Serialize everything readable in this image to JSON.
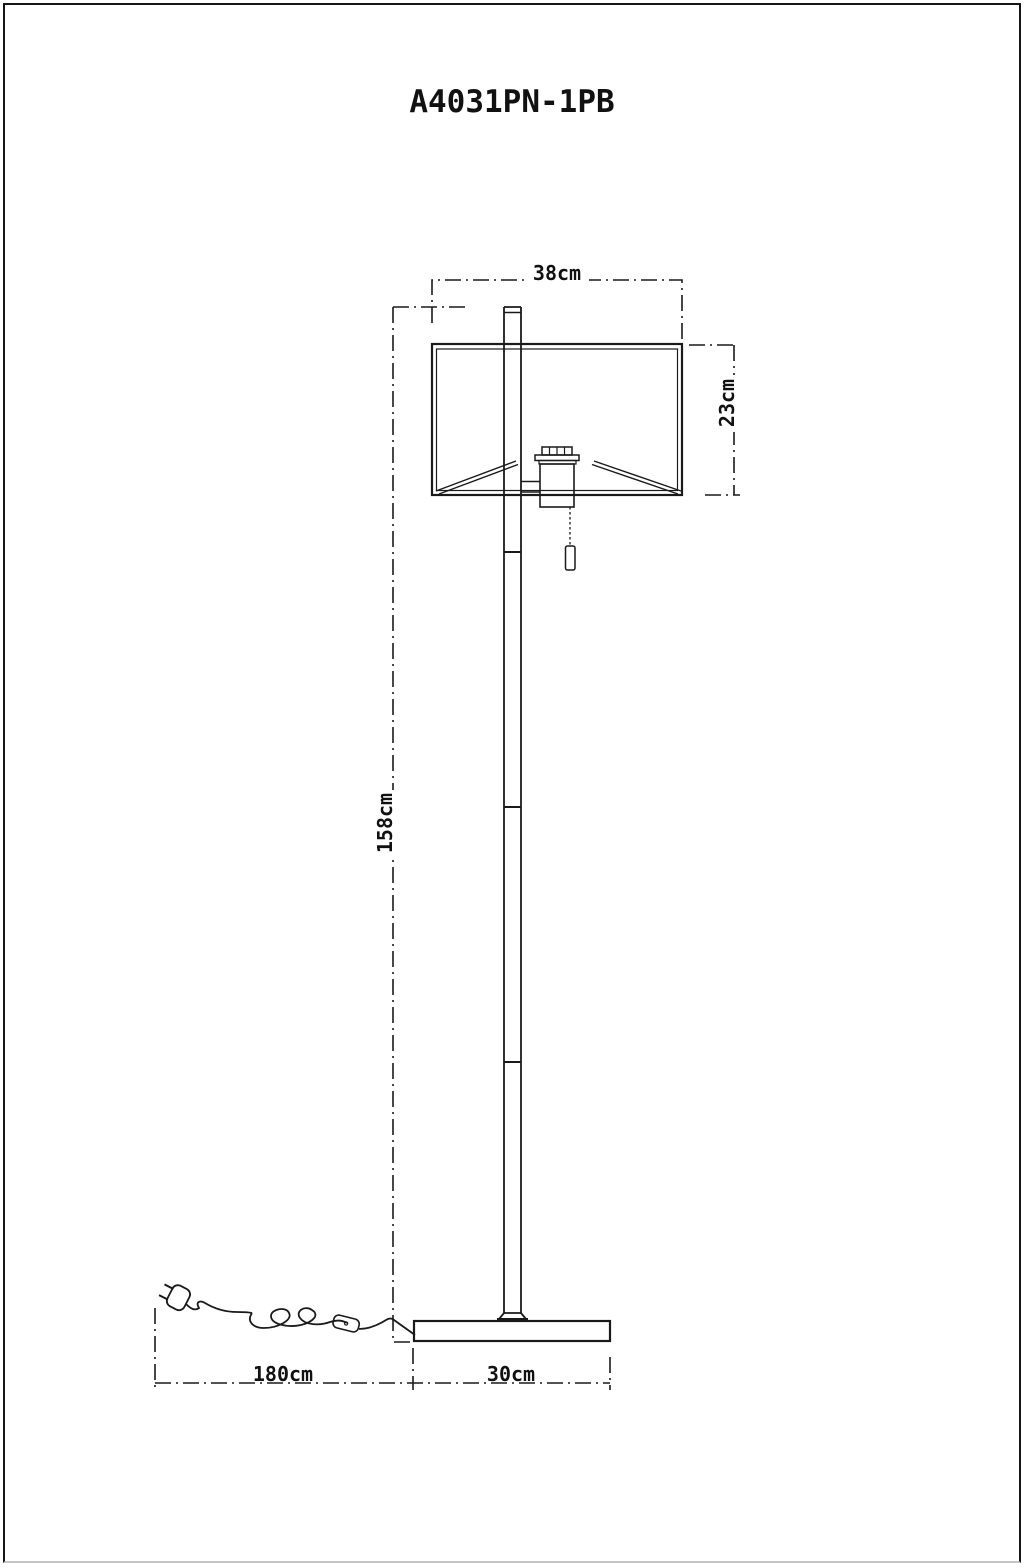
{
  "title": "A4031PN-1PB",
  "drawing": {
    "kind": "floor-lamp technical drawing",
    "dimensions": {
      "shade_width": "38cm",
      "shade_height": "23cm",
      "lamp_height": "158cm",
      "cord_length": "180cm",
      "base_width": "30cm"
    }
  },
  "colors": {
    "line": "#1a1a1a",
    "background": "#ffffff",
    "frame": "#161616"
  }
}
